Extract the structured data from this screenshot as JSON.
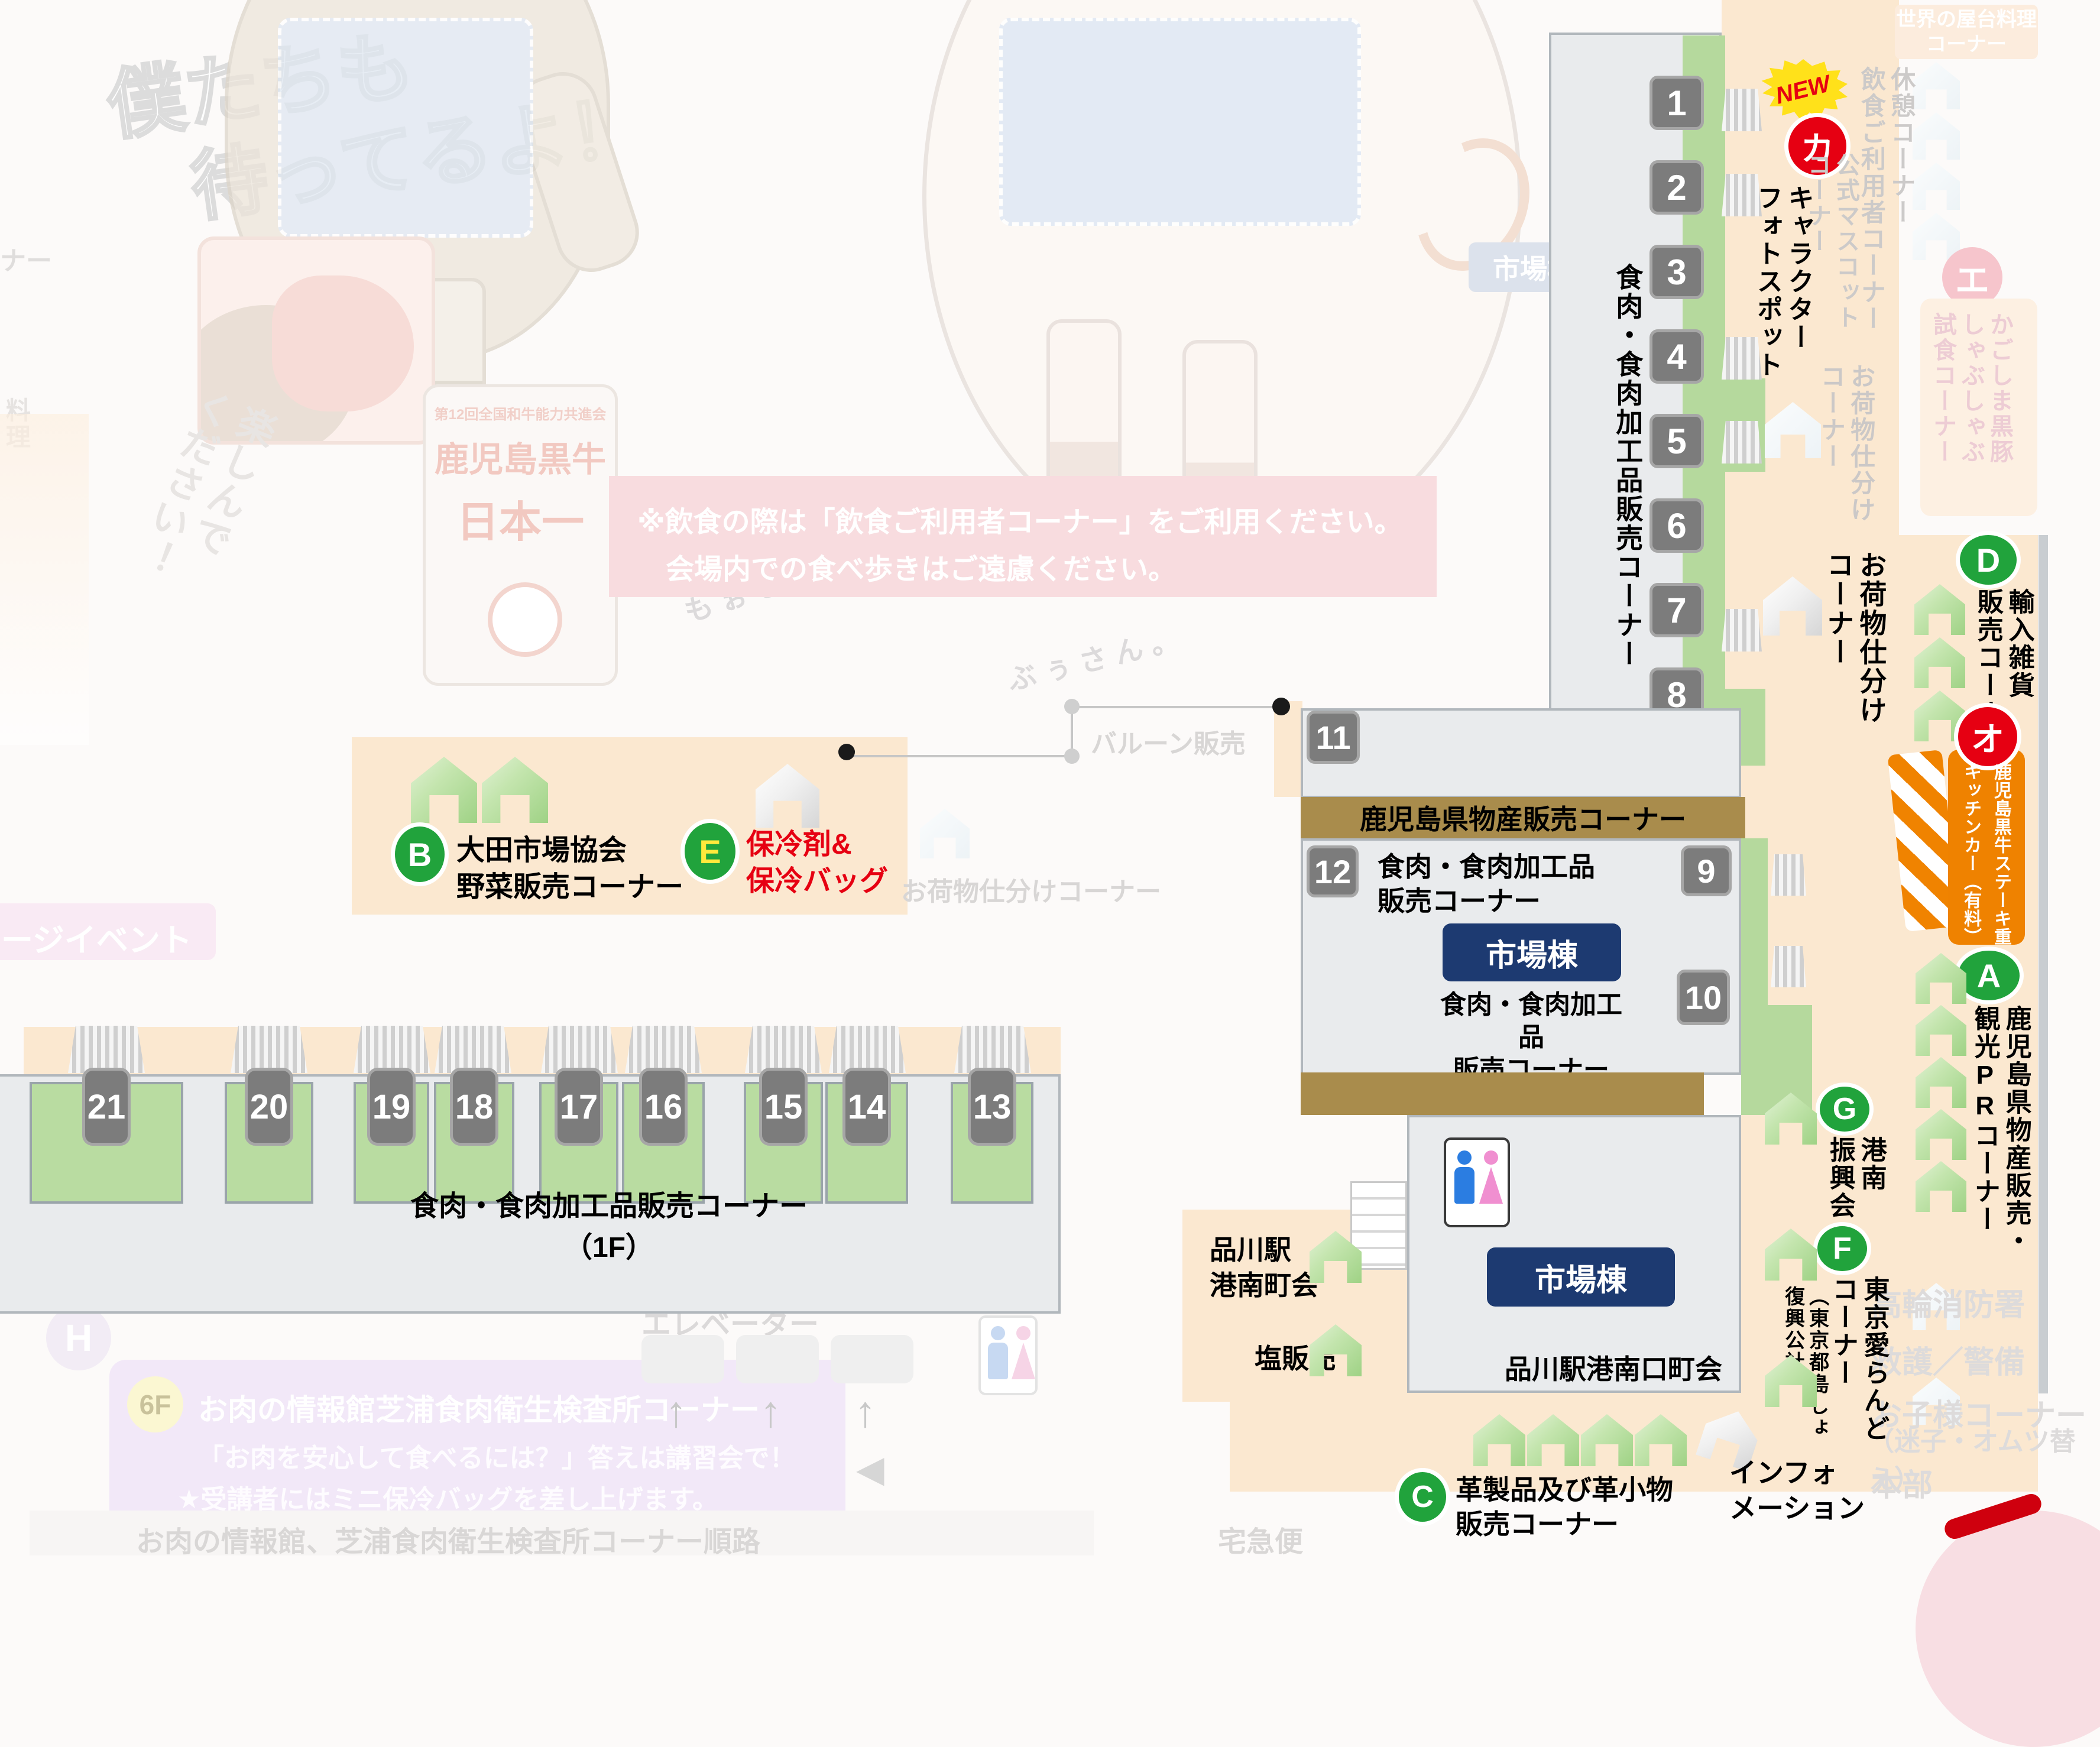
{
  "colors": {
    "accent_red": "#e60012",
    "accent_green": "#21a33c",
    "accent_orange": "#ef8200",
    "navy": "#1d3a71",
    "brown_bar": "#a98c4c",
    "peach_zone": "#fbe8d0",
    "pink_banner": "#f8dcdf",
    "booth_green": "#b9dca1",
    "tag_gray": "#7c7c7c"
  },
  "decor": {
    "waiting1": "僕たちも",
    "waiting2": "待ってるよ！",
    "enjoy": "楽しんで\nください！",
    "mo_san": "もぉさん。",
    "bu_san": "ぶぅさん。",
    "badge_top": "第12回全国和牛能力共進会",
    "badge_name": "鹿児島黒牛",
    "badge_rank": "日本一",
    "cut_left_top": "ナー",
    "cut_left_mid": "料理",
    "stage_event": "ージイベント",
    "market_faded": "市場棟",
    "h_badge": "H"
  },
  "notice": {
    "line1": "※飲食の際は「飲食ご利用者コーナー」をご利用ください。",
    "line2": "会場内での食べ歩きはご遠慮ください。"
  },
  "corridor": {
    "label": "食肉・食肉加工品販売コーナー",
    "numbers": [
      "1",
      "2",
      "3",
      "4",
      "5",
      "6",
      "7",
      "8"
    ],
    "new": "NEW",
    "ka": "カ",
    "photo_spot": "キャラクター\nフォトスポット",
    "baggage": "お荷物仕分け\nコーナー",
    "baggage_faded": "お荷物仕分け\nコーナー"
  },
  "faded_right": {
    "world_food": "世界の屋台料理\nコーナー",
    "rest_eat": "休憩コーナー\n飲食ご利用者コーナー",
    "mascot": "公式マスコット\nコーナー",
    "e_kana": "エ",
    "shabu": "かごしま黒豚\nしゃぶしゃぶ\n試食コーナー",
    "fire": "高輪消防署",
    "rescue": "救護／警備",
    "kids1": "お子様コーナー",
    "kids2": "（迷子・オムツ替え）",
    "hq": "本部"
  },
  "center": {
    "balloon": "バルーン販売",
    "n11": "11",
    "n12": "12",
    "n9": "9",
    "n10": "10",
    "kagoshima_bar": "鹿児島県物産販売コーナー",
    "meat1": "食肉・食肉加工品\n販売コーナー",
    "market1": "市場棟",
    "meat2": "食肉・食肉加工品\n販売コーナー",
    "market2": "市場棟",
    "minamiguchi": "品川駅港南口町会",
    "chokai": "品川駅\n港南町会",
    "salt": "塩販売",
    "baggage_faded": "お荷物仕分けコーナー"
  },
  "spots": {
    "b": "B",
    "b_label": "大田市場協会\n野菜販売コーナー",
    "e": "E",
    "e_label": "保冷剤&\n保冷バッグ",
    "d": "D",
    "d_label": "輸入雑貨\n販売コーナー",
    "o": "オ",
    "o_label": "鹿児島黒牛ステーキ重\nキッチンカー（有料）",
    "a": "A",
    "a_label": "鹿児島県物産販売・\n観光PRコーナー",
    "g": "G",
    "g_label": "港南\n振興会",
    "f": "F",
    "f_label": "東京愛らんど\nコーナー",
    "f_sub": "（東京都島しょ\n復興公社）",
    "c": "C",
    "c_label": "革製品及び革小物\n販売コーナー",
    "info": "インフォ\nメーション"
  },
  "bottom_row": {
    "numbers": [
      "21",
      "20",
      "19",
      "18",
      "17",
      "16",
      "15",
      "14",
      "13"
    ],
    "label": "食肉・食肉加工品販売コーナー（1F）"
  },
  "bottom_left": {
    "to6f": "6Fへ",
    "elevator": "エレベーター",
    "f6": "6F",
    "title": "お肉の情報館芝浦食肉衛生検査所コーナー",
    "line1": "「お肉を安心して食べるには？」答えは講習会で！",
    "line2": "★受講者にはミニ保冷バッグを差し上げます。",
    "route": "お肉の情報館、芝浦食肉衛生検査所コーナー順路",
    "takkyubin": "宅急便",
    "up": "↑",
    "left": "◀"
  }
}
